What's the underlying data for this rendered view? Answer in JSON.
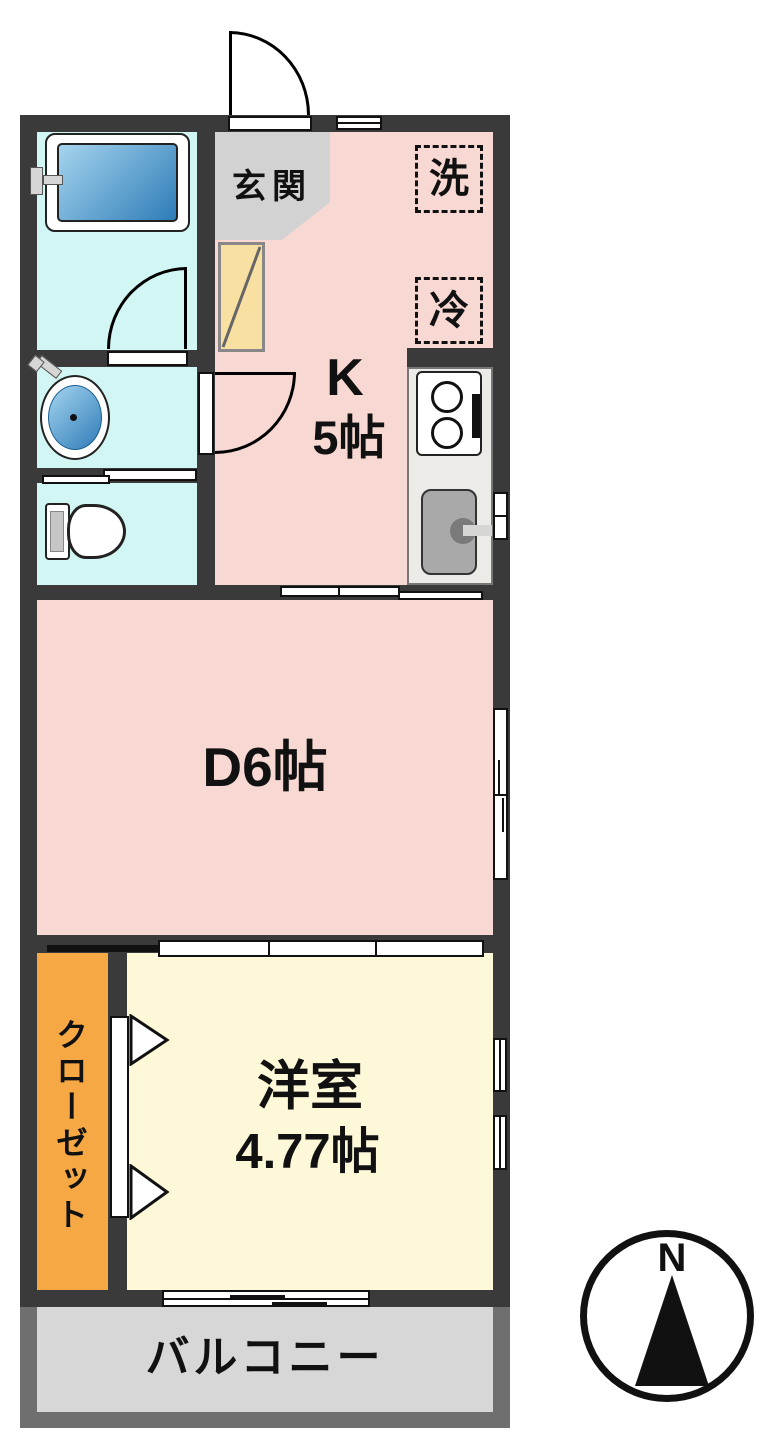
{
  "rooms": {
    "genkan": "玄関",
    "kitchen_label": "K",
    "kitchen_size": "5帖",
    "dining": "D6帖",
    "western_room": "洋室",
    "western_room_size": "4.77帖",
    "closet": "クローゼット",
    "balcony": "バルコニー"
  },
  "fixtures": {
    "washing_machine": "洗",
    "refrigerator": "冷"
  },
  "compass": {
    "north": "N"
  },
  "colors": {
    "wall": "#3a3a3a",
    "kitchen_dining": "#f8d8d2",
    "wet_area": "#d2f6f3",
    "western_room": "#fdf8d8",
    "closet": "#f5a843",
    "genkan": "#d2d2d2",
    "shoe_cabinet": "#f8dfa2",
    "balcony": "#d7d7d7",
    "balcony_wall": "#6f6f6f",
    "tub_blue_light": "#a5d4ee",
    "tub_blue_dark": "#2e7cb8"
  }
}
